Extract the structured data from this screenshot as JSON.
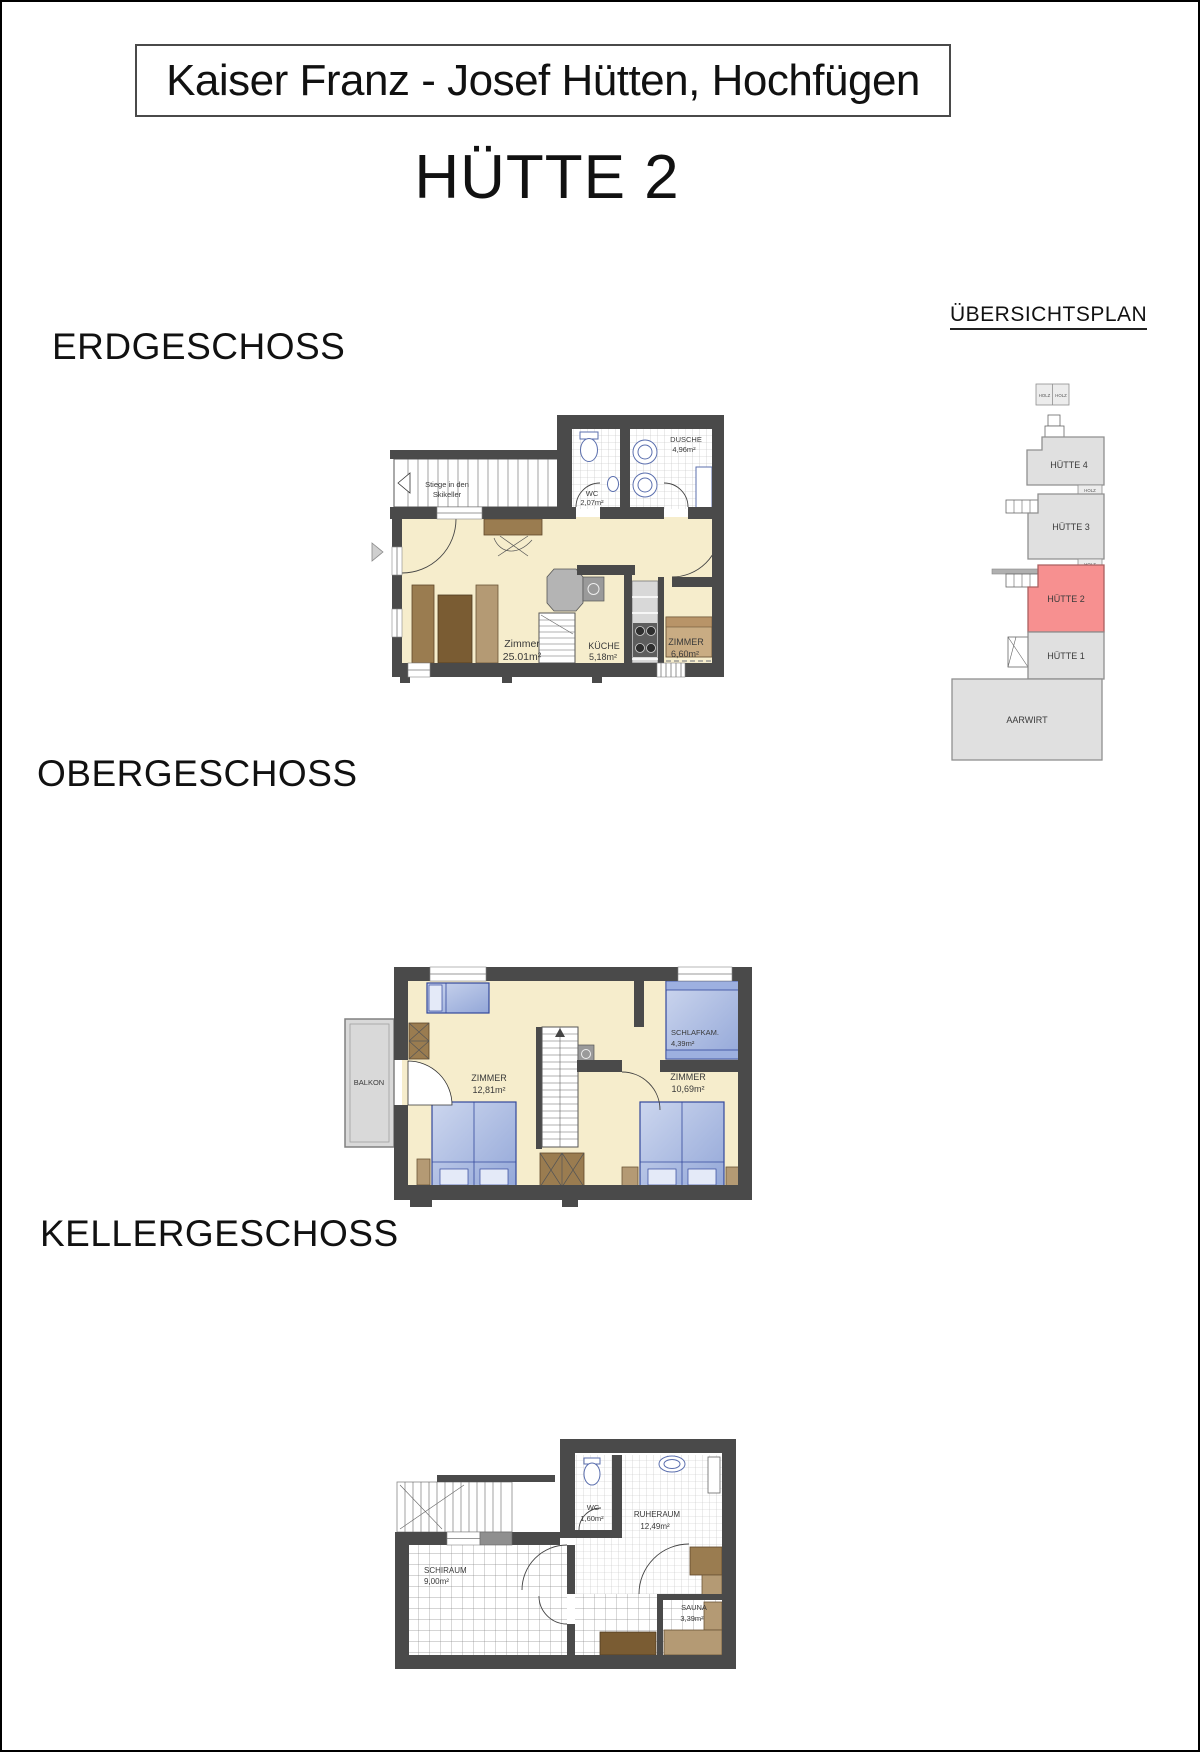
{
  "page": {
    "title": "Kaiser Franz - Josef Hütten, Hochfügen",
    "subtitle": "HÜTTE 2"
  },
  "floors": {
    "erdgeschoss": {
      "heading": "ERDGESCHOSS",
      "stair_note": {
        "line1": "Stiege in den",
        "line2": "Skikeller"
      },
      "rooms": {
        "zimmer": {
          "name": "Zimmer",
          "area": "25.01m²"
        },
        "kueche": {
          "name": "KÜCHE",
          "area": "5,18m²"
        },
        "zimmer2": {
          "name": "ZIMMER",
          "area": "6,60m²"
        },
        "wc": {
          "name": "WC",
          "area": "2,07m²"
        },
        "dusche": {
          "name": "DUSCHE",
          "area": "4,96m²"
        }
      }
    },
    "obergeschoss": {
      "heading": "OBERGESCHOSS",
      "rooms": {
        "balkon": {
          "name": "BALKON"
        },
        "zimmer_links": {
          "name": "ZIMMER",
          "area": "12,81m²"
        },
        "zimmer_rechts": {
          "name": "ZIMMER",
          "area": "10,69m²"
        },
        "schlafkammer": {
          "name": "SCHLAFKAM.",
          "area": "4,39m²"
        }
      }
    },
    "kellergeschoss": {
      "heading": "KELLERGESCHOSS",
      "rooms": {
        "schiraum": {
          "name": "SCHIRAUM",
          "area": "9,00m²"
        },
        "wc": {
          "name": "WC",
          "area": "1,60m²"
        },
        "ruheraum": {
          "name": "RUHERAUM",
          "area": "12,49m²"
        },
        "sauna": {
          "name": "SAUNA",
          "area": "3,39m²"
        }
      }
    }
  },
  "uebersichtsplan": {
    "heading": "ÜBERSICHTSPLAN",
    "holz": "HOLZ",
    "buildings": {
      "huette4": {
        "label": "HÜTTE 4"
      },
      "huette3": {
        "label": "HÜTTE 3"
      },
      "huette2": {
        "label": "HÜTTE 2",
        "highlighted": true
      },
      "huette1": {
        "label": "HÜTTE 1"
      },
      "aarwirt": {
        "label": "AARWIRT"
      }
    }
  },
  "colors": {
    "wall": "#4a4a4a",
    "floor_cream": "#f6edcc",
    "bed_blue": "#a9bce4",
    "wood_brown": "#8a6a46",
    "highlight_red": "#f79090",
    "highlight_text": "#cc2222"
  }
}
